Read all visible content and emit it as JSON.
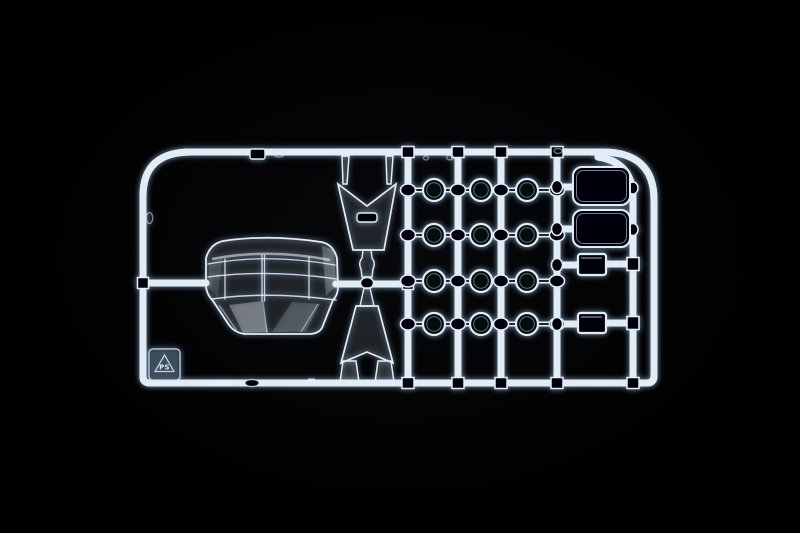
{
  "scene": {
    "subject": "Photograph of a clear transparent plastic model-kit sprue (parts runner) lit against a black background",
    "background_color": "#000000",
    "plastic_highlight_color": "#e3ecf5",
    "glow_color": "#89aed2",
    "dark_core_color": "#05070b"
  },
  "sprue": {
    "material_label": "PS",
    "recycling_icon": "recycling-triangle-icon",
    "parts": [
      {
        "name": "windshield-glazing",
        "count": 1
      },
      {
        "name": "tapered-glass-panel-upper",
        "count": 1
      },
      {
        "name": "tapered-glass-panel-lower",
        "count": 1
      },
      {
        "name": "round-lens",
        "count": 12
      },
      {
        "name": "rounded-window-pane",
        "count": 2
      },
      {
        "name": "small-lens-block",
        "count": 2
      }
    ],
    "lens_grid": {
      "rails": [
        408,
        458,
        501,
        557
      ],
      "columns": [
        434,
        481,
        527
      ],
      "rows": [
        190,
        235,
        281,
        324
      ],
      "radius": 11
    }
  }
}
